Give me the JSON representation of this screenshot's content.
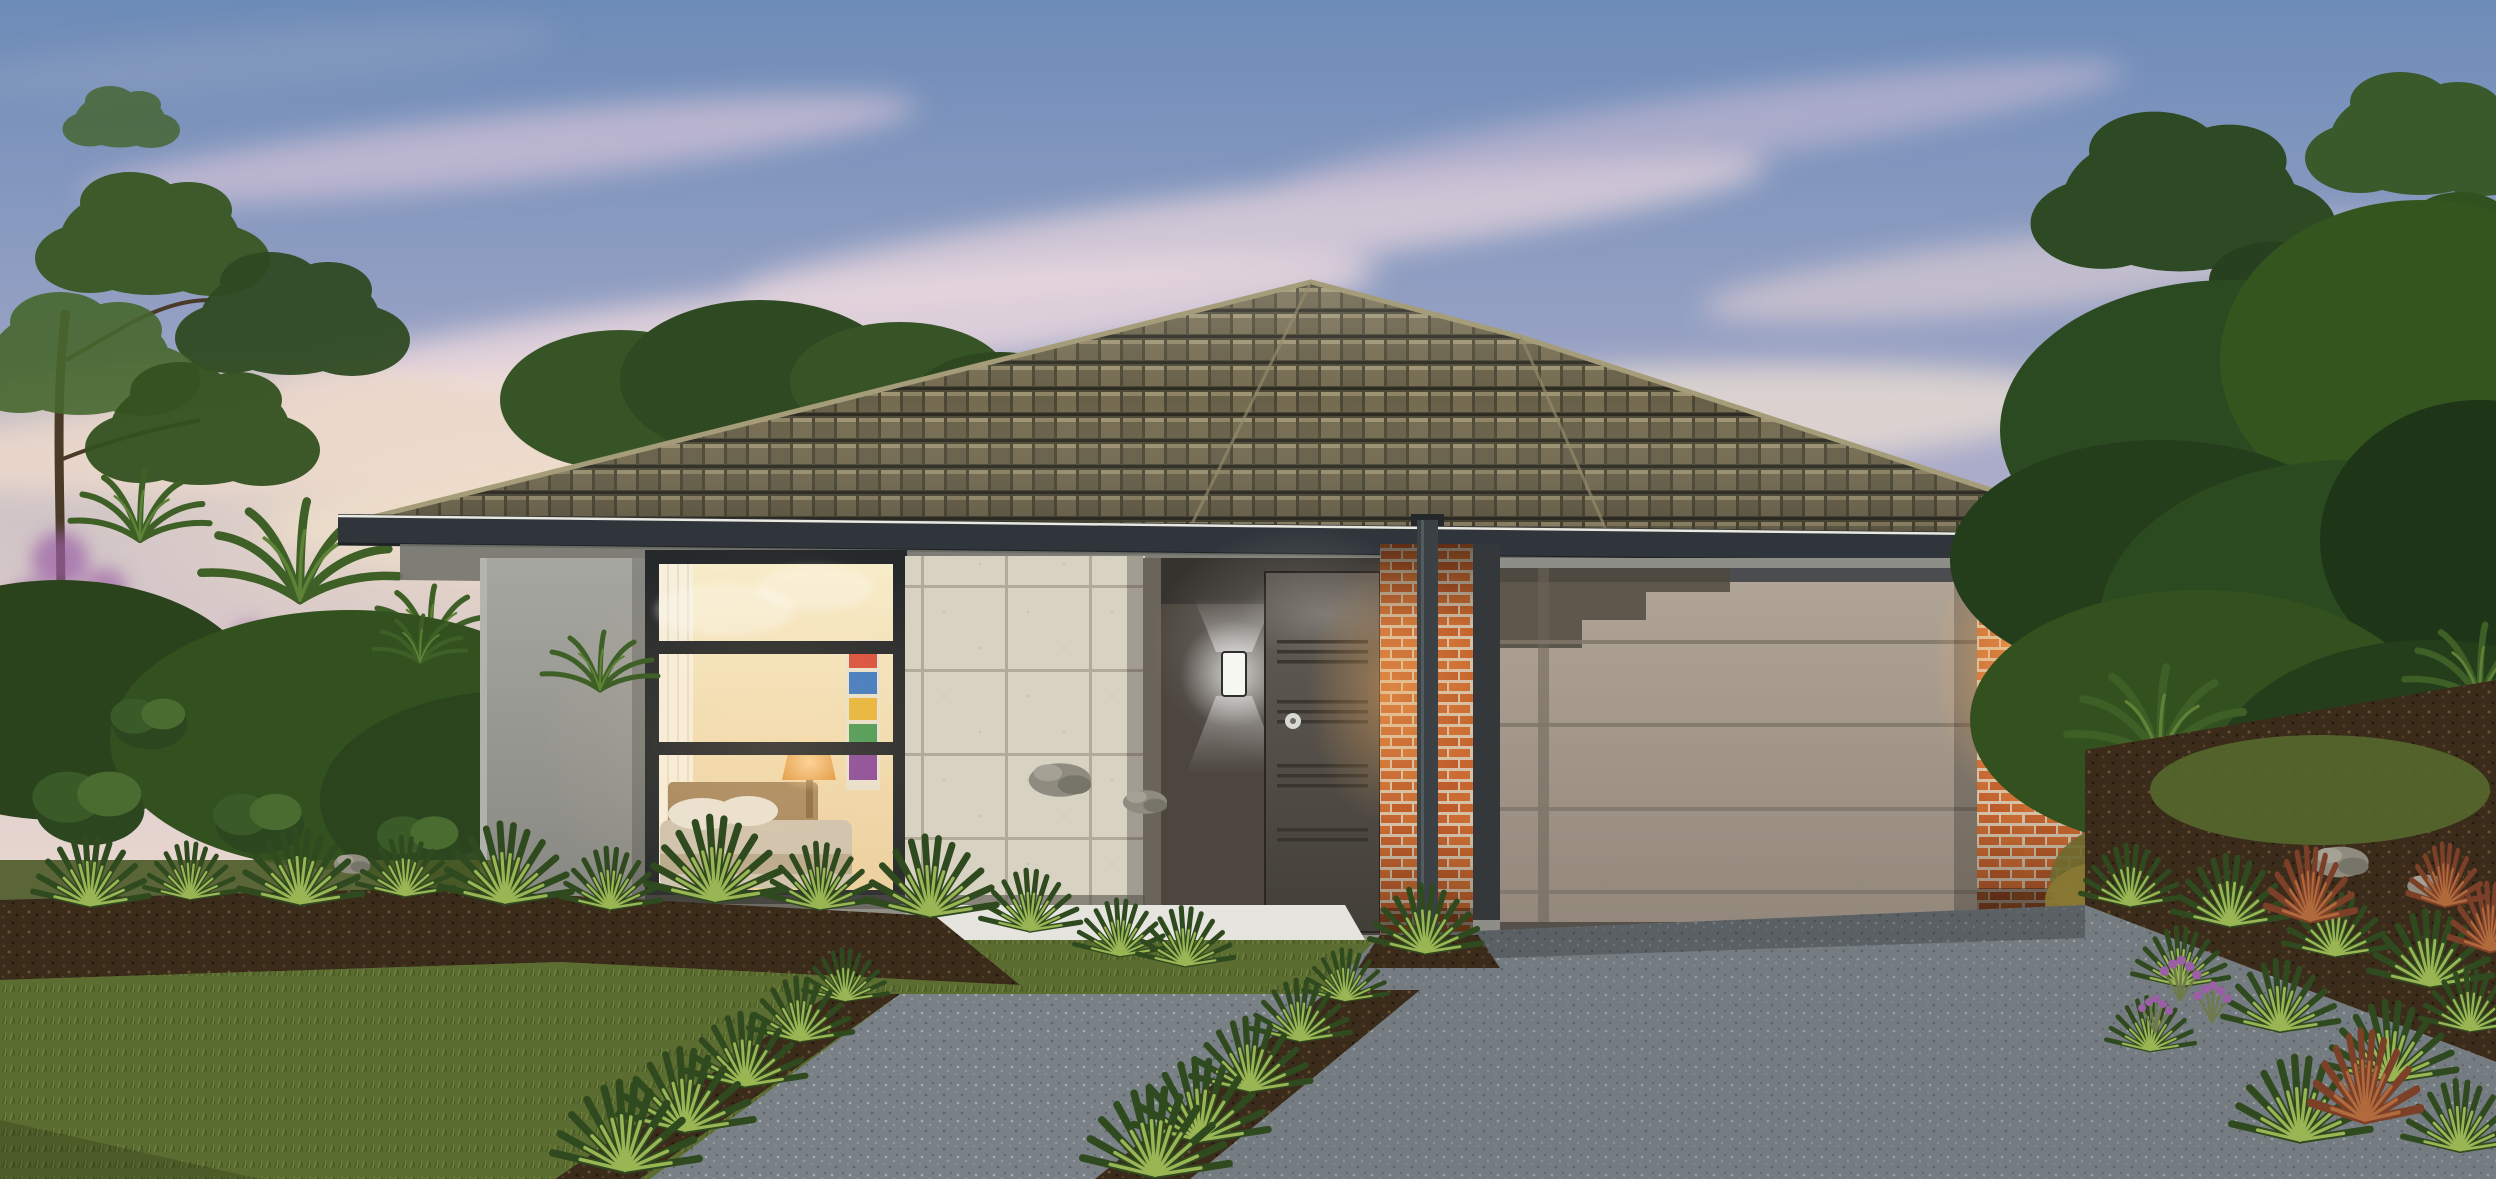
{
  "image": {
    "type": "architectural-render-photo",
    "subject_elements": [
      "dusk-sky",
      "pink-clouds",
      "sunset-glow",
      "gum-tree",
      "background-trees",
      "palm-shrubs",
      "garden-bushes",
      "purple-flowers",
      "single-storey-house",
      "dark-tiled-hip-roof",
      "roof-ridge-capping",
      "gutter-fascia",
      "eaves-soffit",
      "grey-rendered-wall",
      "picture-window",
      "window-mullions",
      "lit-bedroom-interior",
      "bed",
      "pillows",
      "bedside-lamp",
      "wall-art",
      "curtain",
      "feature-tile-clad-wall",
      "recessed-entry-porch",
      "porch-up-down-wall-light",
      "front-door-with-grooves",
      "door-handle",
      "white-porch-step",
      "brick-pier-left",
      "downpipe",
      "garage-opening",
      "sectional-garage-door",
      "brick-pier-right",
      "garage-wall-light",
      "neighbouring-roofline",
      "front-lawn",
      "mulched-garden-beds",
      "yucca-plants",
      "cordyline-plants",
      "lavender-flowers",
      "landscape-rocks",
      "aggregate-front-path",
      "aggregate-driveway"
    ]
  },
  "palette": {
    "sky_top": "#6d8cb8",
    "sky_low": "#edd9cd",
    "sky_horizon": "#f7ead2",
    "cloud_pink": "#e9d4da",
    "foliage_dark": "#22391b",
    "foliage_mid": "#33511f",
    "foliage_light": "#5c7d33",
    "roof_base": "#4b4734",
    "roof_tile_light": "#8b8264",
    "fascia": "#2f353a",
    "render_wall": "#9c9c96",
    "tile_wall": "#d8d2c2",
    "tile_grout": "#b2ab9a",
    "entry_wall": "#4c463f",
    "door": "#55504a",
    "brick": "#c4662d",
    "brick_mortar": "#d5c1a8",
    "garage_door": "#a89d8e",
    "garage_dark": "#44484b",
    "porch": "#e5e4de",
    "paving": "#7a8186",
    "driveway_tint": "#5c646b",
    "lawn": "#5c6d31",
    "lawn_dark": "#4a5a28",
    "mulch": "#3a2b1b",
    "rock": "#8f8c7f",
    "glow_warm": "#ffb45e",
    "glow_white": "#ffffff",
    "window_warm": "#f4e3bd",
    "lamp": "#e0963f",
    "flower_purple": "#9b5fa5",
    "cordyline": "#7c3f28",
    "trunk": "#4a3a28",
    "neighbor_roof": "#3d4245"
  }
}
